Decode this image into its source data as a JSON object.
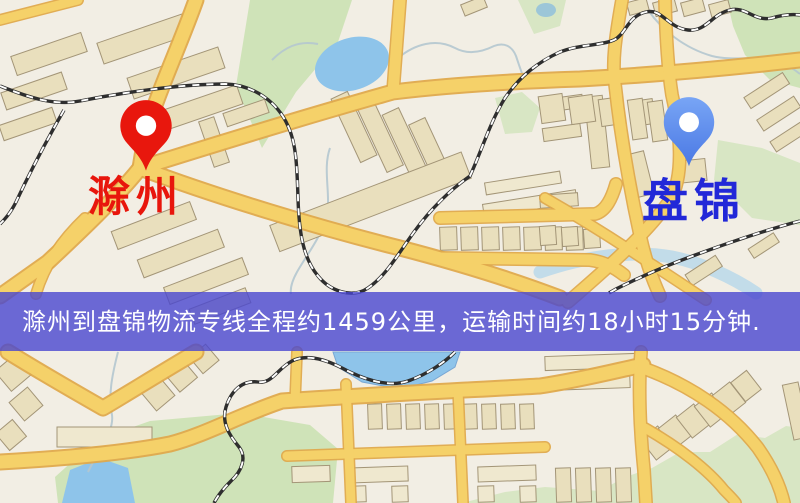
{
  "map": {
    "markers": {
      "origin": {
        "label": "滁州",
        "pin_icon": "red-map-pin-icon",
        "pin_color": "#e8170d",
        "label_color": "#e8160c"
      },
      "destination": {
        "label": "盘锦",
        "pin_icon": "blue-map-pin-icon",
        "pin_color": "#5b8cf0",
        "label_color": "#2228d8"
      }
    },
    "banner": {
      "text": "滁州到盘锦物流专线全程约1459公里，运输时间约18小时15分钟.",
      "background_color": "#4846d0",
      "text_color": "#ffffff"
    },
    "route": {
      "origin_city": "滁州",
      "destination_city": "盘锦",
      "distance_km": "1459",
      "duration_text": "18小时15分钟"
    },
    "palette": {
      "land": "#f2eee4",
      "green_area": "#cfe3b8",
      "water": "#8ec4ea",
      "road_fill": "#f5d169",
      "road_casing": "#dfa94c",
      "building_fill": "#e9dfbd",
      "building_stroke": "#a39577",
      "railway_dark": "#2e2e2e",
      "railway_light": "#ffffff"
    }
  }
}
